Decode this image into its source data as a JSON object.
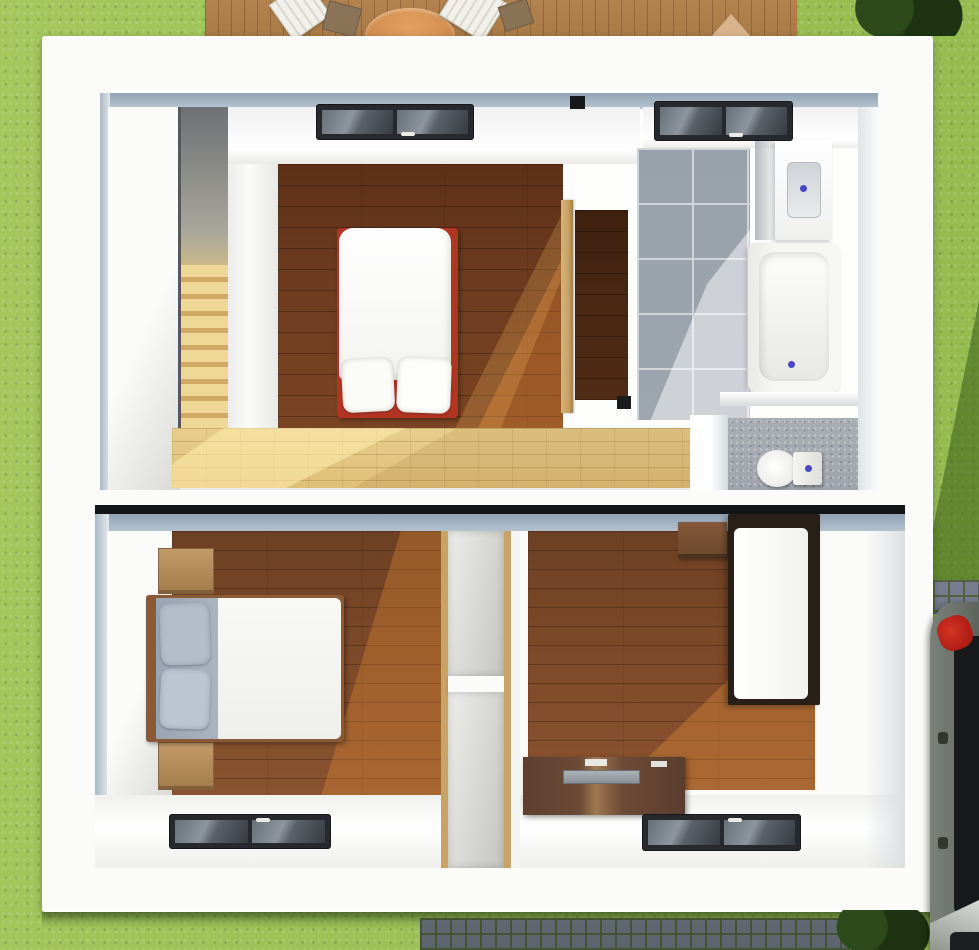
{
  "scene": {
    "type": "3d-floor-plan-render",
    "view": "top-down",
    "floors_shown": 2
  },
  "palette": {
    "grass": "#9cc054",
    "grass-shadow": "#466e24",
    "deck": "#b3824e",
    "wall-white": "#fbfbf9",
    "wall-blue": "#a9b8c6",
    "wood-dark": "#6e3b20",
    "wood-mid": "#7f4a29",
    "wood-light": "#e8cd8e",
    "wood-sun": "#c8772f",
    "tile": "#9da5af",
    "tile-grout": "#d0d5da",
    "door-tan": "#c9a265",
    "bed-red": "#b23422",
    "pillow-gray": "#b4bdca",
    "fixture-white": "#f6f6f3",
    "faucet-blue": "#4747c8",
    "sky-frame": "#26292d",
    "sky-glass": "#5a6169",
    "cobble": "#707889",
    "car-body": "#6f746e",
    "car-glass": "#17191b",
    "car-light": "#b01d15",
    "bush": "#244016"
  },
  "upper_floor": {
    "rooms": [
      {
        "name": "staircase",
        "floor": "light wood steps"
      },
      {
        "name": "master-bedroom",
        "floor": "dark wood",
        "furniture": [
          "double bed with red frame and two white pillows"
        ],
        "skylights": 1
      },
      {
        "name": "hallway",
        "floor": "light wood"
      },
      {
        "name": "closet",
        "floor": "dark wood",
        "door": "tan open door"
      },
      {
        "name": "bathroom",
        "floor": "gray tile",
        "fixtures": [
          "vanity sink",
          "bathtub",
          "toilet"
        ],
        "skylights": 1
      }
    ]
  },
  "lower_floor": {
    "rooms": [
      {
        "name": "bedroom-left",
        "floor": "wood",
        "furniture": [
          "double bed with gray pillows",
          "two wooden nightstands"
        ],
        "skylights": 1
      },
      {
        "name": "shelving-column",
        "floor": "white",
        "furniture": [
          "two open storage niches"
        ]
      },
      {
        "name": "bedroom-right",
        "floor": "wood",
        "furniture": [
          "single bed with dark frame",
          "wall cabinet",
          "wooden desk with laptop"
        ],
        "skylights": 1
      }
    ]
  },
  "exterior": {
    "top": "wooden deck with white loungers, dark chairs and round table",
    "left": "lawn",
    "right": "lawn with shadow, paved cobble path, parked gray car with red taillight, dark bushes",
    "bottom": "lawn with cobblestone path and bush"
  }
}
